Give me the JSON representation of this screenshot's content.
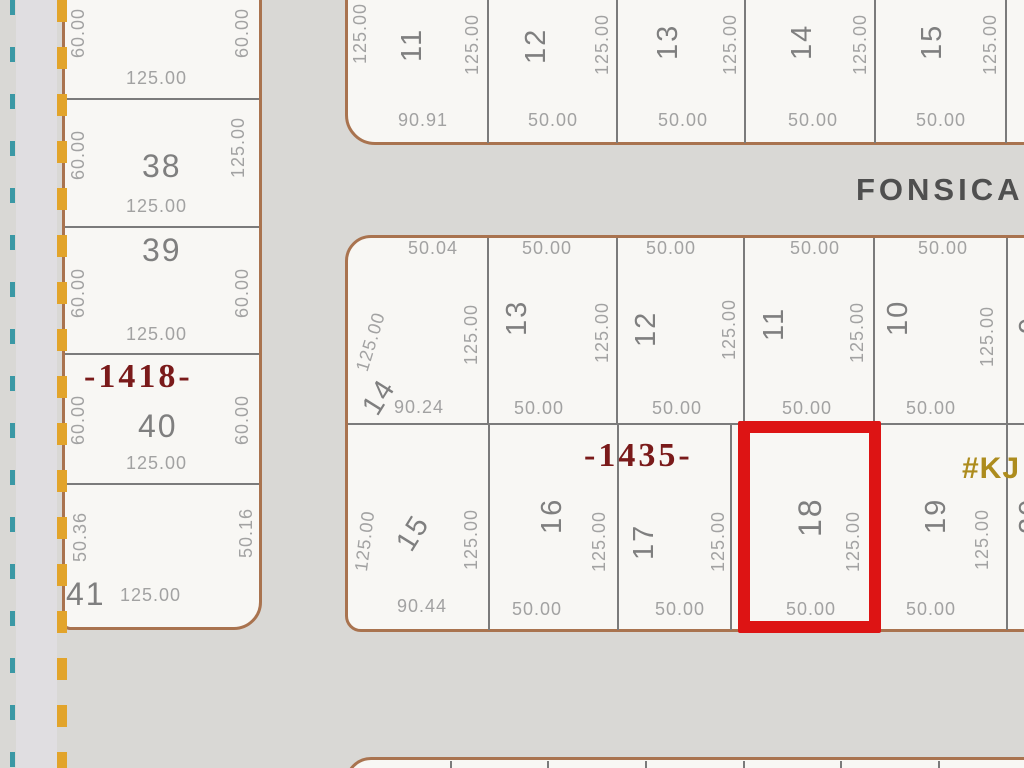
{
  "street": {
    "name": "FONSICA"
  },
  "marker": {
    "text": "#KJ"
  },
  "blocks": {
    "b1418": {
      "label": "-1418-",
      "lot_top": {
        "left": "60.00",
        "right": "60.00",
        "bottom": "125.00"
      },
      "lot38": {
        "number": "38",
        "left": "60.00",
        "right": "125.00",
        "bottom": "125.00"
      },
      "lot39": {
        "number": "39",
        "left": "60.00",
        "right": "60.00",
        "bottom": "125.00"
      },
      "lot40": {
        "number": "40",
        "left": "60.00",
        "right": "60.00",
        "bottom": "125.00"
      },
      "lot41": {
        "number": "41",
        "left": "50.36",
        "right": "50.16",
        "bottom": "125.00"
      }
    },
    "north": {
      "lot11": {
        "number": "11",
        "left": "125.00",
        "right": "125.00",
        "bottom": "90.91"
      },
      "lot12": {
        "number": "12",
        "right": "125.00",
        "bottom": "50.00"
      },
      "lot13": {
        "number": "13",
        "right": "125.00",
        "bottom": "50.00"
      },
      "lot14": {
        "number": "14",
        "right": "125.00",
        "bottom": "50.00"
      },
      "lot15": {
        "number": "15",
        "right": "125.00",
        "bottom": "50.00"
      }
    },
    "b1435": {
      "label": "-1435-",
      "row_north": {
        "lot14": {
          "number": "14",
          "top": "50.04",
          "left": "125.00",
          "right": "125.00",
          "bottom": "90.24"
        },
        "lot13": {
          "number": "13",
          "top": "50.00",
          "right": "125.00",
          "bottom": "50.00"
        },
        "lot12": {
          "number": "12",
          "top": "50.00",
          "right": "125.00",
          "bottom": "50.00"
        },
        "lot11": {
          "number": "11",
          "top": "50.00",
          "right": "125.00",
          "bottom": "50.00"
        },
        "lot10": {
          "number": "10",
          "top": "50.00",
          "right": "125.00",
          "bottom": "50.00"
        },
        "lot9": {
          "number": "9"
        }
      },
      "row_south": {
        "lot15": {
          "number": "15",
          "left": "125.00",
          "right": "125.00",
          "bottom": "90.44"
        },
        "lot16": {
          "number": "16",
          "right": "125.00",
          "bottom": "50.00"
        },
        "lot17": {
          "number": "17",
          "right": "125.00",
          "bottom": "50.00"
        },
        "lot18": {
          "number": "18",
          "right": "125.00",
          "bottom": "50.00",
          "highlighted": true
        },
        "lot19": {
          "number": "19",
          "right": "125.00",
          "bottom": "50.00"
        },
        "lot20": {
          "number": "20"
        }
      }
    }
  },
  "colors": {
    "highlight_red": "#dd1414",
    "block_border": "#a9734f",
    "block_label_red": "#7a1a1a",
    "marker_yellow": "#ad8c1e",
    "teal_dash": "#3b98a5",
    "yellow_dash": "#e2a42b"
  }
}
